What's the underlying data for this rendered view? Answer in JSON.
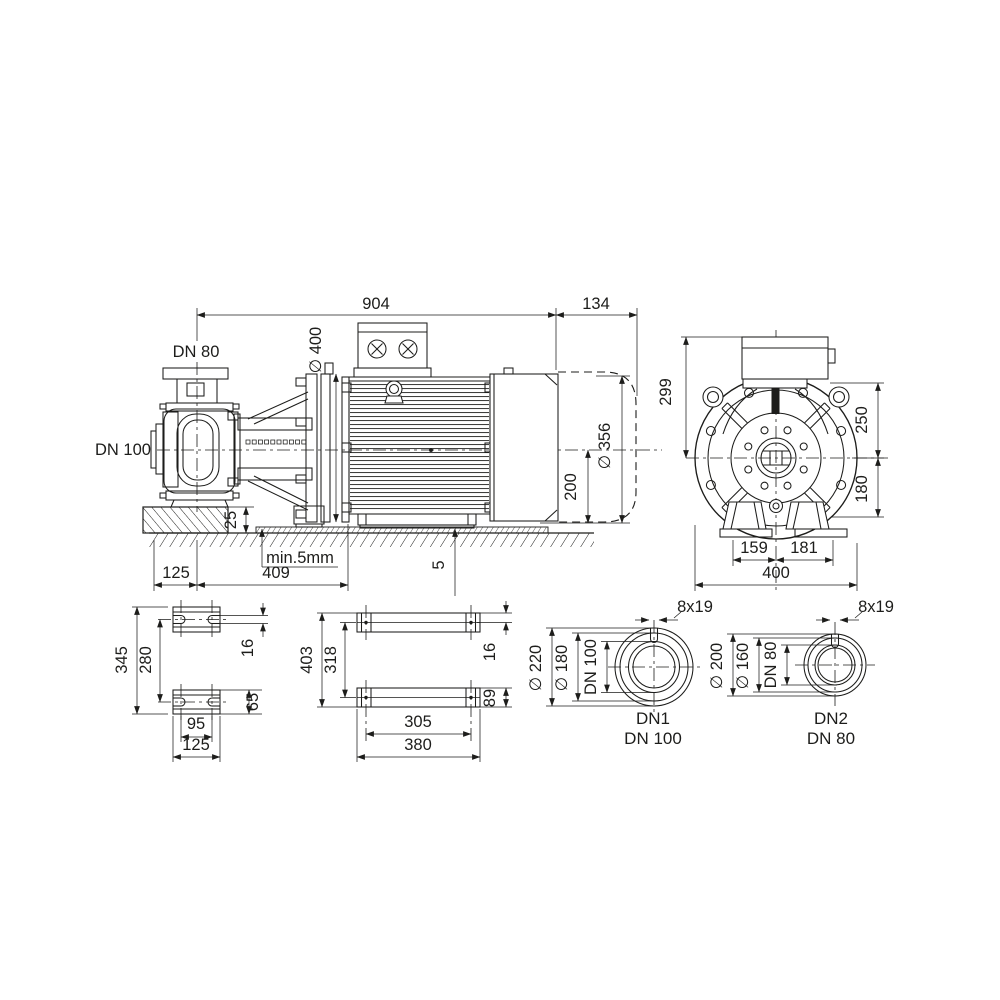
{
  "colors": {
    "line": "#1d1d1b",
    "background": "#ffffff"
  },
  "views": {
    "side": {
      "length": "904",
      "removal_space": "134",
      "discharge": "DN 80",
      "suction": "DN 100",
      "flange_dia": "∅ 400",
      "motor_dia": "∅ 356",
      "shaft_height": "200",
      "pedestal_height": "25",
      "grout": "min.5mm",
      "shim": "5",
      "foot_offset": "125",
      "foot_span": "409"
    },
    "front": {
      "height_above_center": "299",
      "upper_radius": "250",
      "lower_radius": "180",
      "foot_left": "159",
      "foot_right": "181",
      "overall_width": "400"
    },
    "pump_feet": {
      "overall": "345",
      "spacing": "280",
      "slot_width": "16",
      "foot_height": "65",
      "slot_spacing": "95",
      "foot_width": "125"
    },
    "motor_feet": {
      "overall": "403",
      "hole_spacing_v": "318",
      "hole_offset": "16",
      "rail_height": "89",
      "hole_spacing_h": "305",
      "rail_width": "380"
    },
    "flange_dn1": {
      "outer_dia": "∅ 220",
      "bolt_circle": "∅ 180",
      "bore": "DN 100",
      "holes": "8x19",
      "label": "DN1",
      "size": "DN 100"
    },
    "flange_dn2": {
      "outer_dia": "∅ 200",
      "bolt_circle": "∅ 160",
      "bore": "DN 80",
      "holes": "8x19",
      "label": "DN2",
      "size": "DN 80"
    }
  }
}
